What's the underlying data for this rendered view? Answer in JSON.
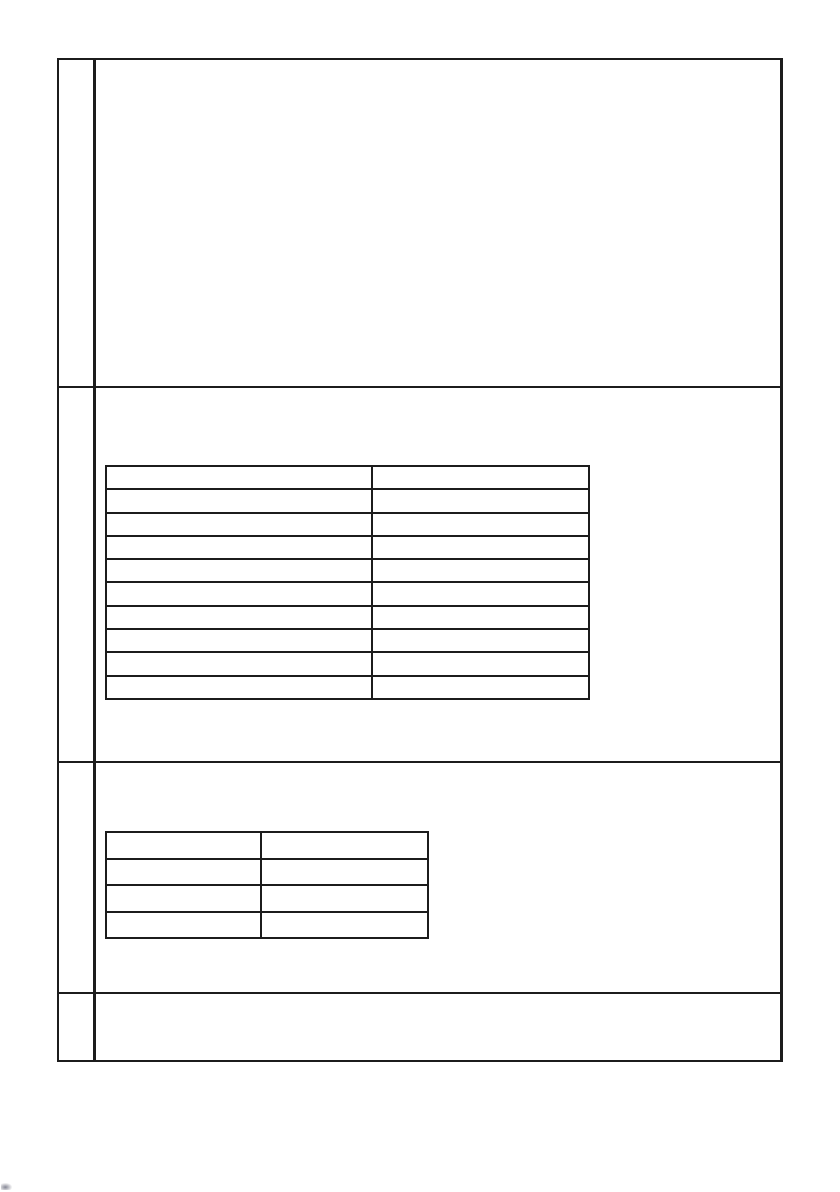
{
  "page": {
    "background_color": "#ffffff",
    "line_color": "#1c1c1c"
  },
  "outer_table": {
    "description": "blank scanned answer grid, 4 rows, narrow left number column",
    "rows": [
      {
        "label": "",
        "content": ""
      },
      {
        "label": "",
        "content": ""
      },
      {
        "label": "",
        "content": ""
      },
      {
        "label": "",
        "content": ""
      }
    ]
  },
  "inner_table_1": {
    "description": "empty two-column table, 10 rows",
    "rows": [
      [
        "",
        ""
      ],
      [
        "",
        ""
      ],
      [
        "",
        ""
      ],
      [
        "",
        ""
      ],
      [
        "",
        ""
      ],
      [
        "",
        ""
      ],
      [
        "",
        ""
      ],
      [
        "",
        ""
      ],
      [
        "",
        ""
      ],
      [
        "",
        ""
      ]
    ]
  },
  "inner_table_2": {
    "description": "empty two-column table, 4 rows",
    "rows": [
      [
        "",
        ""
      ],
      [
        "",
        ""
      ],
      [
        "",
        ""
      ],
      [
        "",
        ""
      ]
    ]
  }
}
